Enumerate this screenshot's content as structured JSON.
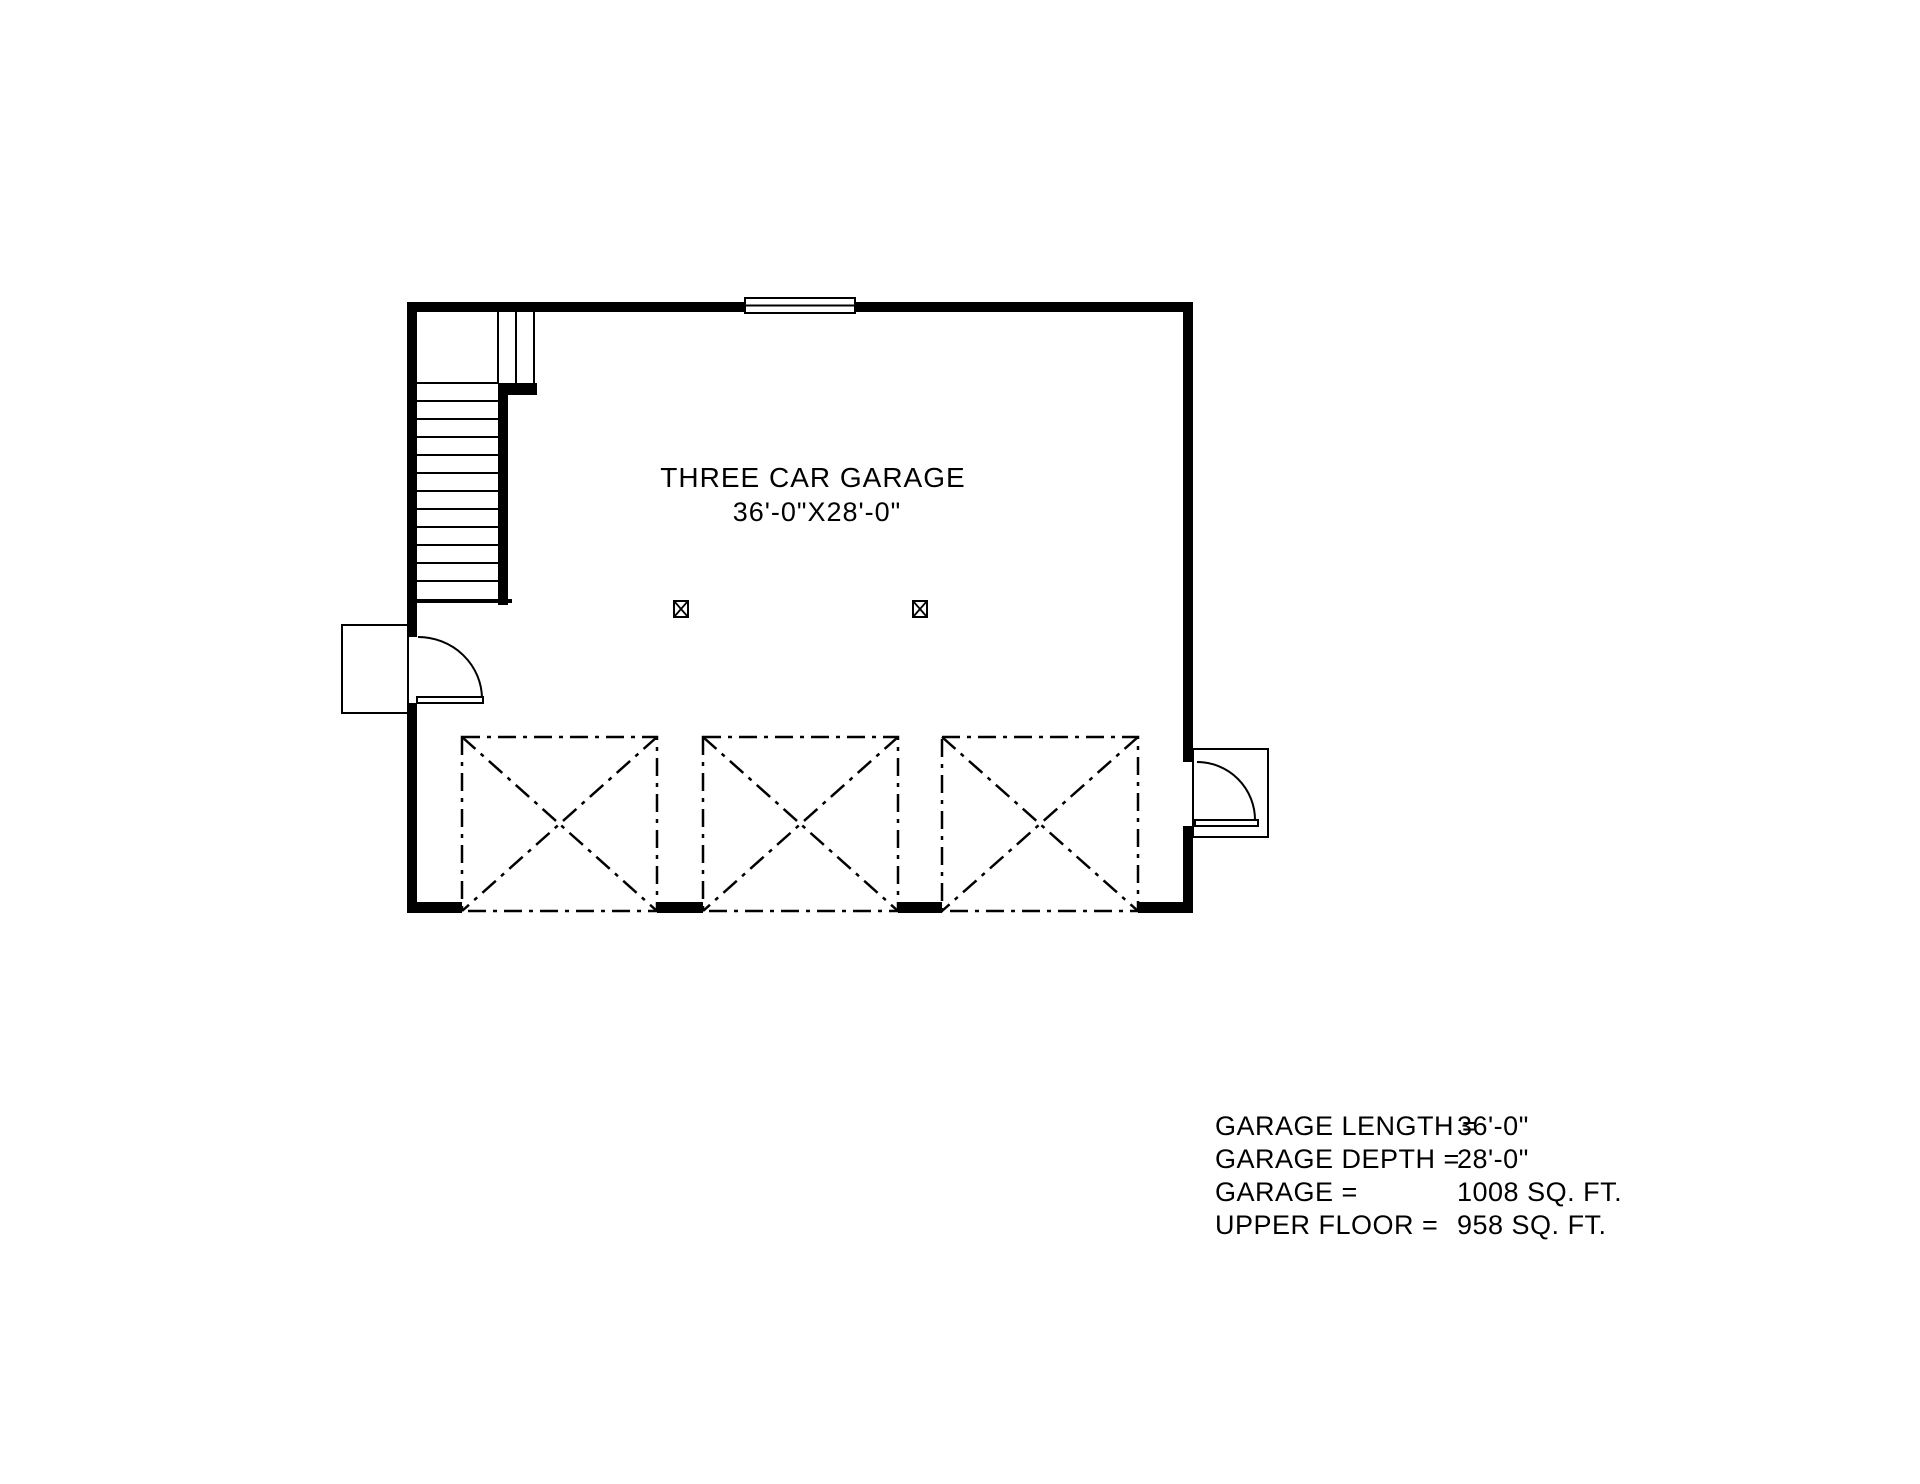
{
  "plan": {
    "room_label": "THREE CAR GARAGE",
    "room_dimensions": "36'-0\"X28'-0\""
  },
  "summary": {
    "rows": [
      {
        "label": "GARAGE LENGTH =",
        "value": "36'-0\""
      },
      {
        "label": "GARAGE DEPTH =",
        "value": "28'-0\""
      },
      {
        "label": "GARAGE =",
        "value": "1008 SQ. FT."
      },
      {
        "label": "UPPER FLOOR =",
        "value": "958 SQ. FT."
      }
    ]
  },
  "colors": {
    "line": "#000000",
    "background": "#ffffff"
  }
}
